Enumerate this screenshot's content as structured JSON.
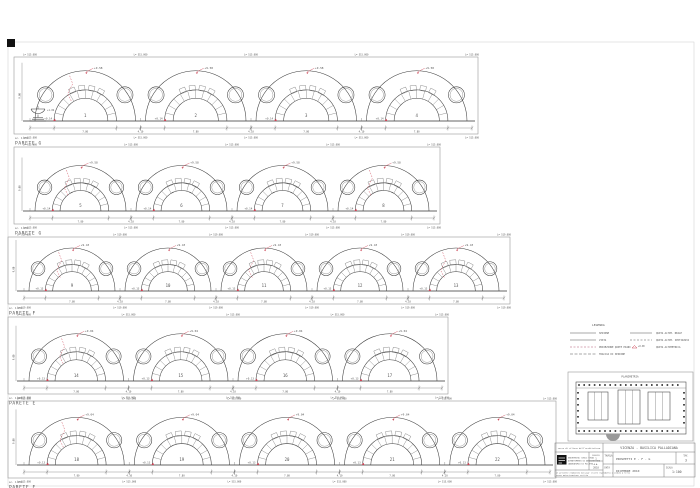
{
  "sheet": {
    "bg": "#ffffff",
    "line": "#3d3d3d",
    "red": "#cc4455",
    "frame": "#999999"
  },
  "rows": [
    {
      "label": "PARETE G",
      "scale_note": "sc. 1:100",
      "bays": [
        "1",
        "2",
        "3",
        "4"
      ],
      "apex": "+9.58",
      "base_mark": "+0.14",
      "span_dim": "7.80",
      "gap_dim": "4.10",
      "top_dim": "L= 515.000",
      "left_dim": "9.00",
      "fountain_mark": "+1.02",
      "cracks": [
        0
      ],
      "fountain": true,
      "frame": {
        "x": 14,
        "y": 57,
        "w": 464,
        "h": 77
      }
    },
    {
      "label": "PARETE G",
      "scale_note": "sc. 1:100",
      "bays": [
        "5",
        "6",
        "7",
        "8"
      ],
      "apex": "+9.58",
      "base_mark": "+0.14",
      "span_dim": "7.80",
      "gap_dim": "4.10",
      "top_dim": "L= 515.000",
      "left_dim": "9.00",
      "cracks": [
        0,
        3
      ],
      "fountain": false,
      "frame": {
        "x": 14,
        "y": 147,
        "w": 426,
        "h": 77
      }
    },
    {
      "label": "PARETE F",
      "scale_note": "sc. 1:100",
      "bays": [
        "9",
        "10",
        "11",
        "12",
        "13"
      ],
      "apex": "+9.43",
      "base_mark": "+0.13",
      "span_dim": "7.80",
      "gap_dim": "4.10",
      "top_dim": "L= 519.000",
      "left_dim": "9.00",
      "cracks": [
        0,
        2,
        4
      ],
      "fountain": false,
      "frame": {
        "x": 8,
        "y": 237,
        "w": 502,
        "h": 67
      }
    },
    {
      "label": "PARETE E",
      "scale_note": "sc. 1:100",
      "bays": [
        "14",
        "15",
        "16",
        "17"
      ],
      "apex": "+9.04",
      "base_mark": "+0.13",
      "span_dim": "7.80",
      "gap_dim": "4.10",
      "top_dim": "L= 515.000",
      "left_dim": "9.00",
      "cracks": [
        0
      ],
      "fountain": false,
      "frame": {
        "x": 8,
        "y": 317,
        "w": 440,
        "h": 77
      }
    },
    {
      "label": "PARETE E",
      "scale_note": "sc. 1:100",
      "bays": [
        "18",
        "19",
        "20",
        "21",
        "22"
      ],
      "apex": "+9.04",
      "base_mark": "+0.13",
      "span_dim": "7.80",
      "gap_dim": "4.10",
      "top_dim": "L= 515.000",
      "left_dim": "9.00",
      "cracks": [
        0
      ],
      "fountain": false,
      "frame": {
        "x": 8,
        "y": 401,
        "w": 548,
        "h": 77
      }
    }
  ],
  "legend": {
    "title": "LEGENDA",
    "left": [
      {
        "label": "SEZIONE",
        "color": "#555",
        "dash": ""
      },
      {
        "label": "VISTA",
        "color": "#555",
        "dash": ""
      },
      {
        "label": "PROIEZIONE QUOTE PIANI",
        "color": "#b05570",
        "dash": "2 1.5"
      },
      {
        "label": "TRACCIA DI SEZIONE",
        "color": "#555",
        "dash": "3 1.5"
      }
    ],
    "right": [
      {
        "label": "QUOTA ALTIM. REALE",
        "color": "#555",
        "dash": ""
      },
      {
        "label": "QUOTA ALTIM. IPOTIZZATA",
        "color": "#555",
        "dash": "2 1.5"
      },
      {
        "label": "QUOTA ALTIMETRICA",
        "symbol": "+0.00",
        "color": "#cc4455"
      }
    ]
  },
  "key_plan": {
    "label": "PLANIMETRIA"
  },
  "title_block": {
    "project": "VICENZA - BASILICA PALLADIANA",
    "course": "corso di rilievo dell'architettura",
    "tavola_label": "TAVOLA",
    "drawing_title": "PROSPETTI E - F - G",
    "tav_no_label": "TAV.",
    "tav_no": "3",
    "data_label": "DATA",
    "data_value": "DICEMBRE 2010",
    "scala_label": "SCALA",
    "scala_value": "1:100",
    "org_lines": [
      "UNIVERSITA' DEGLI STUDI",
      "DIPARTIMENTO DI ARCHITETTURA",
      "LABORATORIO DI RILIEVO"
    ],
    "cells": [
      "FOGLIO",
      "1",
      "A.A.",
      "2010"
    ],
    "disclaimer_lines": [
      "il presente elaborato non puo' essere riprodotto o ceduto a terzi",
      "senza autorizzazione scritta"
    ]
  }
}
